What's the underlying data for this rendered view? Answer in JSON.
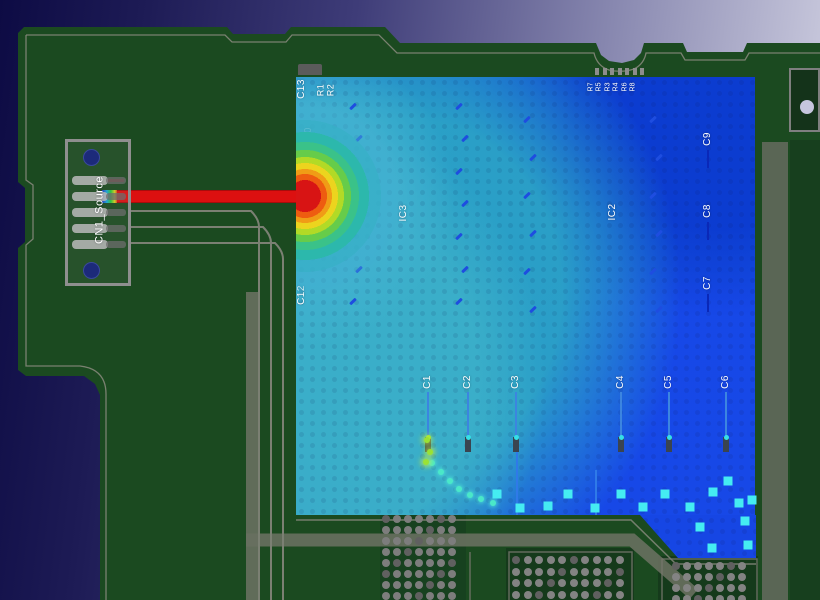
{
  "view": {
    "description": "PCB power-net current-density overlay",
    "width": 820,
    "height": 600
  },
  "background": {
    "left": "#0d0b44",
    "mid": "#3e3c78",
    "right": "#c9c9dd"
  },
  "board": {
    "fill": "#1b4a20",
    "dark_zone": "#153a1b",
    "silk": "#8b8b7f",
    "copper_band": "#68705f"
  },
  "connector": {
    "label": "CN1_Source",
    "body_color": "#8f8f8f",
    "pin_color": "#b6b6b6",
    "hole_color": "#1c2a7a",
    "holes": [
      [
        90,
        156
      ],
      [
        90,
        269
      ]
    ],
    "pin_ys": [
      176,
      192,
      208,
      224,
      240
    ]
  },
  "source_trace": {
    "color": "#dc1010",
    "rainbow": [
      "#2038c8",
      "#18a8d8",
      "#28c838",
      "#d8d020"
    ]
  },
  "hotspot": {
    "cx": 305,
    "cy": 196,
    "ring_colors": [
      "#d81414",
      "#ee5c10",
      "#f09c16",
      "#ecd41e",
      "#b2da26",
      "#66cc4a",
      "#3ac289",
      "#2cb8ac",
      "#38b0c8",
      "#41aed0"
    ]
  },
  "heatmap": {
    "base": "#1560d0",
    "teal": "#2ba3c6",
    "cyan": "#3bafc9",
    "royal": "#1747e8",
    "dark_blue": "#0c3bd0",
    "mid_blue": "#1c74cc",
    "extension": "#1646e4"
  },
  "refdes_labels": [
    {
      "t": "C13",
      "x": 302,
      "y": 89,
      "s": 10
    },
    {
      "t": "R1",
      "x": 321,
      "y": 90,
      "s": 9
    },
    {
      "t": "R2",
      "x": 331,
      "y": 90,
      "s": 9
    },
    {
      "t": "C10",
      "x": 309,
      "y": 137,
      "s": 10
    },
    {
      "t": "C11",
      "x": 309,
      "y": 224,
      "s": 10
    },
    {
      "t": "C12",
      "x": 302,
      "y": 295,
      "s": 10
    },
    {
      "t": "IC3",
      "x": 404,
      "y": 213,
      "s": 10
    },
    {
      "t": "IC2",
      "x": 613,
      "y": 212,
      "s": 10
    },
    {
      "t": "C9",
      "x": 708,
      "y": 139,
      "s": 10
    },
    {
      "t": "C8",
      "x": 708,
      "y": 211,
      "s": 10
    },
    {
      "t": "C7",
      "x": 708,
      "y": 283,
      "s": 10
    },
    {
      "t": "C1",
      "x": 428,
      "y": 382,
      "s": 10
    },
    {
      "t": "C2",
      "x": 468,
      "y": 382,
      "s": 10
    },
    {
      "t": "C3",
      "x": 516,
      "y": 382,
      "s": 10
    },
    {
      "t": "C4",
      "x": 621,
      "y": 382,
      "s": 10
    },
    {
      "t": "C5",
      "x": 669,
      "y": 382,
      "s": 10
    },
    {
      "t": "C6",
      "x": 726,
      "y": 382,
      "s": 10
    }
  ],
  "resistor_row": {
    "labels": [
      "R7",
      "R5",
      "R3",
      "R4",
      "R6",
      "R8"
    ],
    "x0": 591,
    "pitch": 8.4,
    "y": 87,
    "s": 7
  },
  "cap_stubs": {
    "xs": [
      428,
      468,
      516,
      621,
      669,
      726
    ],
    "y1": 392,
    "y2": 437,
    "pad_h": 15,
    "line_color": "#3c85e0",
    "pad_color": "#3a4450",
    "dot_color": "#35e0e8"
  },
  "c789_stubs": {
    "x": 708,
    "ys": [
      150,
      222,
      294
    ],
    "len": 18,
    "color": "#0a28b8"
  },
  "extra_stubs": [
    [
      517,
      452,
      515
    ],
    [
      596,
      470,
      515
    ]
  ],
  "via_grids": [
    {
      "x": 386,
      "y": 519,
      "cols": 7,
      "rows": 8,
      "pitch": 11,
      "r": 4,
      "color": "#7d7d7d"
    },
    {
      "x": 516,
      "y": 560,
      "cols": 10,
      "rows": 4,
      "pitch": 11.5,
      "r": 4,
      "color": "#838383"
    },
    {
      "x": 676,
      "y": 566,
      "cols": 7,
      "rows": 4,
      "pitch": 11,
      "r": 4,
      "color": "#838383"
    }
  ],
  "top_pads": {
    "x0": 595,
    "y": 68,
    "count": 7,
    "pitch": 7.5,
    "w": 4,
    "h": 7,
    "color": "#8d8d8d"
  },
  "c13_bar": {
    "x": 298,
    "y": 64,
    "w": 24,
    "h": 11
  },
  "dash_columns": [
    {
      "x": 349,
      "ys": [
        105,
        137,
        170,
        202,
        235,
        268,
        300
      ]
    },
    {
      "x": 455,
      "ys": [
        105,
        137,
        170,
        202,
        235,
        268,
        300
      ]
    },
    {
      "x": 523,
      "ys": [
        118,
        156,
        194,
        232,
        270,
        308
      ]
    },
    {
      "x": 649,
      "ys": [
        118,
        156,
        194,
        232,
        270,
        308
      ]
    }
  ],
  "dash_color": "#1e4de0",
  "via_chain": [
    [
      432,
      463
    ],
    [
      441,
      472
    ],
    [
      450,
      481
    ],
    [
      459,
      489
    ],
    [
      470,
      495
    ],
    [
      481,
      499
    ],
    [
      493,
      503
    ]
  ],
  "x_marks": [
    [
      497,
      494
    ],
    [
      520,
      508
    ],
    [
      548,
      506
    ],
    [
      568,
      494
    ],
    [
      595,
      508
    ],
    [
      621,
      494
    ],
    [
      643,
      507
    ],
    [
      665,
      494
    ],
    [
      690,
      507
    ],
    [
      713,
      492
    ],
    [
      728,
      481
    ],
    [
      739,
      503
    ],
    [
      700,
      527
    ],
    [
      745,
      521
    ],
    [
      712,
      548
    ],
    [
      748,
      545
    ],
    [
      752,
      500
    ]
  ],
  "bright_dots": [
    [
      427,
      440
    ],
    [
      430,
      452
    ],
    [
      426,
      462
    ]
  ],
  "mark_colors": {
    "x": "#45ecf2",
    "dot": "#9ae234",
    "chain": "#4ae8c8"
  },
  "right_component": {
    "x": 789,
    "y": 68,
    "w": 31,
    "h": 64,
    "hole": [
      805,
      105
    ],
    "hole_color": "#c6c6de"
  }
}
